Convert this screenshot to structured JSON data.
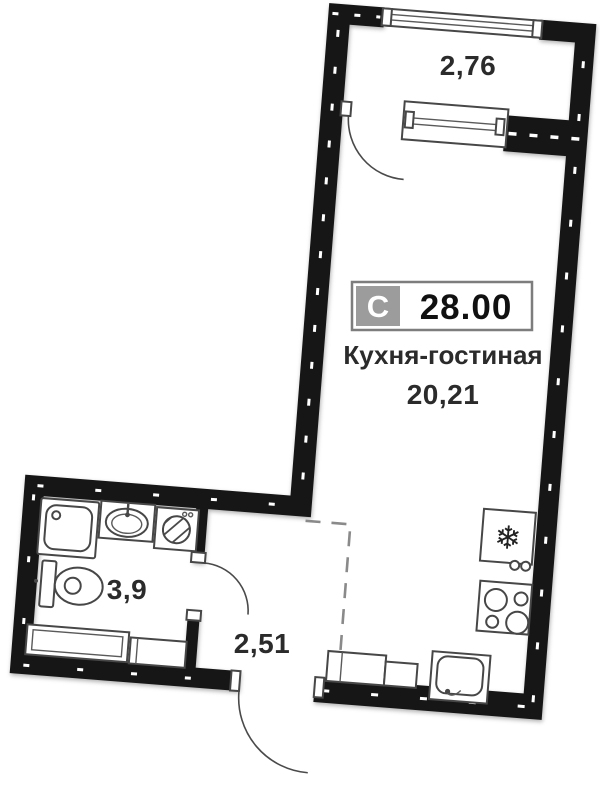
{
  "badge": {
    "letter": "С",
    "total_area": "28.00"
  },
  "rooms": {
    "kitchen_living": {
      "name": "Кухня-гостиная",
      "area": "20,21"
    },
    "balcony": {
      "area": "2,76"
    },
    "bathroom": {
      "area": "3,9"
    },
    "hallway": {
      "area": "2,51"
    }
  },
  "icons": {
    "fridge_snowflake": "❄"
  },
  "colors": {
    "wall": "#161616",
    "badge_gray": "#9c9c9c",
    "badge_border": "#7d7d7d",
    "dash_boundary": "#8a8a8a",
    "label_text": "#2b2b2b"
  }
}
